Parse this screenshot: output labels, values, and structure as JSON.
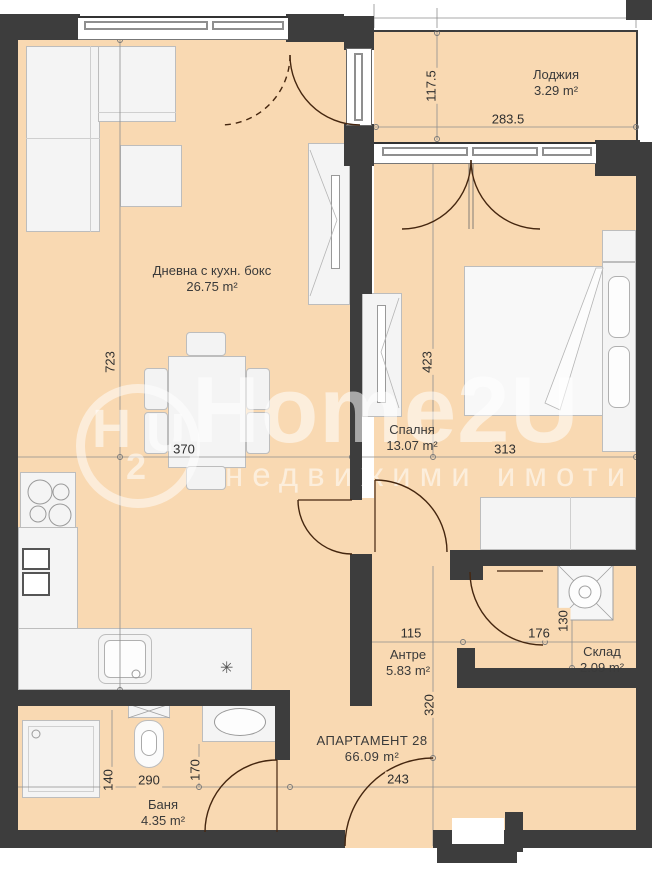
{
  "rooms": [
    {
      "id": "loggia",
      "name": "Лоджия",
      "area": "3.29 m²"
    },
    {
      "id": "living",
      "name": "Дневна с кухн. бокс",
      "area": "26.75 m²"
    },
    {
      "id": "bedroom",
      "name": "Спалня",
      "area": "13.07 m²"
    },
    {
      "id": "hall",
      "name": "Антре",
      "area": "5.83 m²"
    },
    {
      "id": "storage",
      "name": "Склад",
      "area": "2.09 m²"
    },
    {
      "id": "bath",
      "name": "Баня",
      "area": "4.35 m²"
    }
  ],
  "apartment": {
    "name": "АПАРТАМЕНТ 28",
    "area": "66.09 m²"
  },
  "dimensions": [
    {
      "id": "loggia-height",
      "value": "117.5",
      "orientation": "vertical"
    },
    {
      "id": "loggia-width",
      "value": "283.5",
      "orientation": "horizontal"
    },
    {
      "id": "living-height",
      "value": "723",
      "orientation": "vertical"
    },
    {
      "id": "living-width",
      "value": "370",
      "orientation": "horizontal"
    },
    {
      "id": "bedroom-height",
      "value": "423",
      "orientation": "vertical"
    },
    {
      "id": "bedroom-width",
      "value": "313",
      "orientation": "horizontal"
    },
    {
      "id": "hall-width",
      "value": "115",
      "orientation": "horizontal"
    },
    {
      "id": "storage-width",
      "value": "176",
      "orientation": "horizontal"
    },
    {
      "id": "storage-height",
      "value": "130",
      "orientation": "vertical"
    },
    {
      "id": "hall-height",
      "value": "320",
      "orientation": "vertical"
    },
    {
      "id": "entrance-width",
      "value": "243",
      "orientation": "horizontal"
    },
    {
      "id": "bath-left-height",
      "value": "140",
      "orientation": "vertical"
    },
    {
      "id": "bath-width",
      "value": "290",
      "orientation": "horizontal"
    },
    {
      "id": "bath-right-height",
      "value": "170",
      "orientation": "vertical"
    }
  ],
  "watermark": {
    "brand": "Home2U",
    "tagline": "недвижими имоти",
    "logo_main": "H",
    "logo_sub": "2",
    "logo_tail": "U"
  },
  "symbols": {
    "vent": "✳"
  },
  "colors": {
    "floor": "#f9d9b2",
    "wall": "#3d3d3d",
    "door_arc": "#45260f",
    "furniture_outline": "#bdbdbd",
    "dimension_text": "#2e2e2e"
  }
}
